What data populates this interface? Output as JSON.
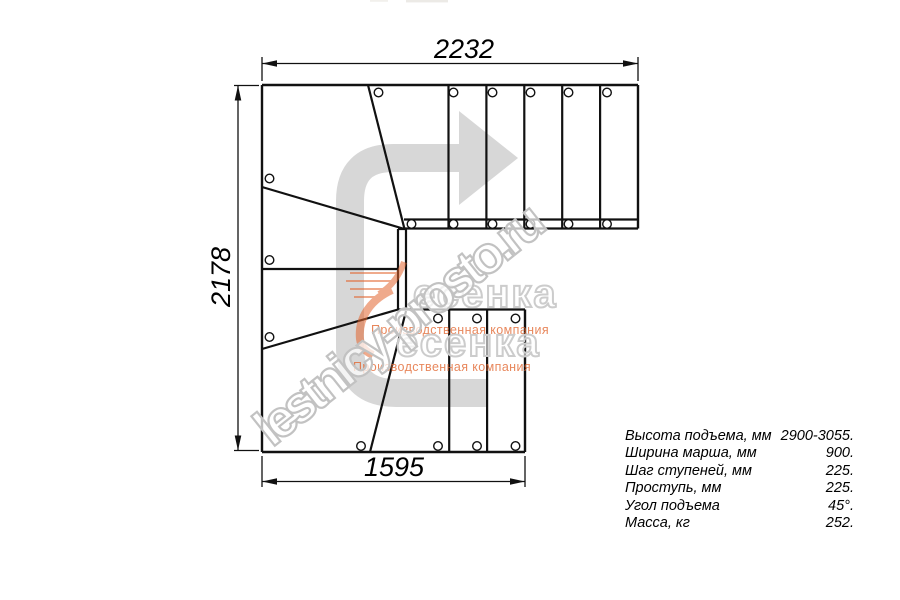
{
  "dimensions": {
    "top_width_mm": "2232",
    "left_height_mm": "2178",
    "bottom_width_mm": "1595"
  },
  "watermark": {
    "site": "lestnicy-prosto.ru",
    "logo_word": "есенка",
    "logo_tagline": "Производственная компания",
    "orange_color": "#e2662f",
    "gray_color": "#c2c2c2"
  },
  "drawing": {
    "line_color": "#111111",
    "arrow_color": "#d7d7d7"
  },
  "specs": {
    "rows": [
      {
        "label": "Высота подъема, мм",
        "value": "2900-3055."
      },
      {
        "label": "Ширина марша, мм",
        "value": "900."
      },
      {
        "label": "Шаг ступеней, мм",
        "value": "225."
      },
      {
        "label": "Проступь, мм",
        "value": "225."
      },
      {
        "label": "Угол подъема",
        "value": "45°."
      },
      {
        "label": "Масса, кг",
        "value": "252."
      }
    ]
  }
}
